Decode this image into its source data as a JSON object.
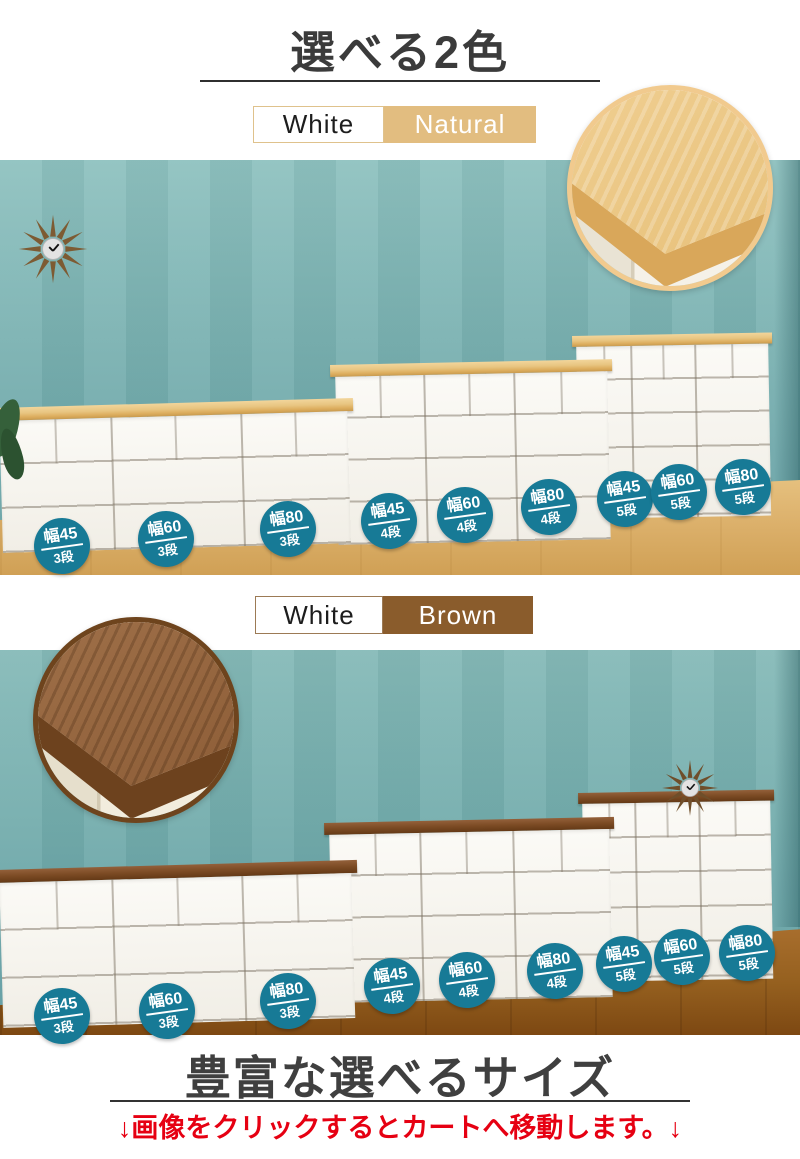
{
  "header": {
    "title": "選べる2色"
  },
  "natural_section": {
    "tab_white": "White",
    "tab_color": "Natural",
    "badges": [
      {
        "width": "幅45",
        "tiers": "3段"
      },
      {
        "width": "幅60",
        "tiers": "3段"
      },
      {
        "width": "幅80",
        "tiers": "3段"
      },
      {
        "width": "幅45",
        "tiers": "4段"
      },
      {
        "width": "幅60",
        "tiers": "4段"
      },
      {
        "width": "幅80",
        "tiers": "4段"
      },
      {
        "width": "幅45",
        "tiers": "5段"
      },
      {
        "width": "幅60",
        "tiers": "5段"
      },
      {
        "width": "幅80",
        "tiers": "5段"
      }
    ]
  },
  "brown_section": {
    "tab_white": "White",
    "tab_color": "Brown",
    "badges": [
      {
        "width": "幅45",
        "tiers": "3段"
      },
      {
        "width": "幅60",
        "tiers": "3段"
      },
      {
        "width": "幅80",
        "tiers": "3段"
      },
      {
        "width": "幅45",
        "tiers": "4段"
      },
      {
        "width": "幅60",
        "tiers": "4段"
      },
      {
        "width": "幅80",
        "tiers": "4段"
      },
      {
        "width": "幅45",
        "tiers": "5段"
      },
      {
        "width": "幅60",
        "tiers": "5段"
      },
      {
        "width": "幅80",
        "tiers": "5段"
      }
    ]
  },
  "footer": {
    "title": "豊富な選べるサイズ",
    "note": "↓画像をクリックするとカートへ移動します。↓"
  },
  "icons": {
    "clock": "sunburst-wall-clock-icon"
  },
  "colors": {
    "badge_teal": "#177a96",
    "natural_tan": "#e2bd80",
    "brown": "#8a5c2c",
    "note_red": "#e60012",
    "wall_teal": "#7cb3b2",
    "floor_light": "#ddb26d",
    "floor_dark": "#95601f"
  }
}
